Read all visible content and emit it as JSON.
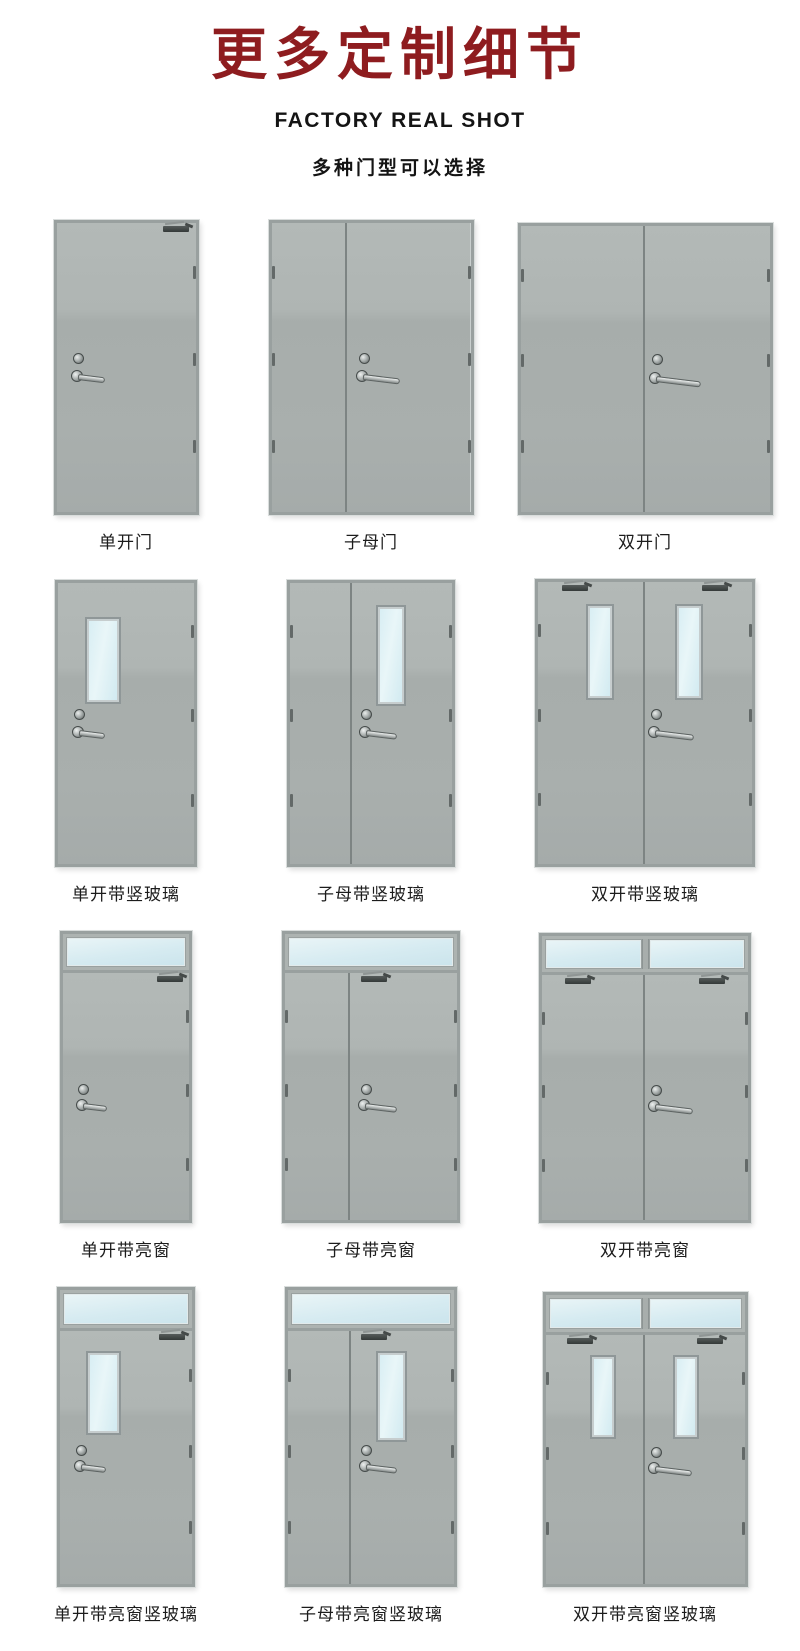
{
  "header": {
    "title": "更多定制细节",
    "subtitle_en": "FACTORY REAL SHOT",
    "subtitle_cn": "多种门型可以选择"
  },
  "colors": {
    "title_red": "#8e1c1f",
    "door_gray": "#a9afad",
    "frame_gray": "#99a09f",
    "glass_blue": "#d6ebf1",
    "label_black": "#1c1c1c"
  },
  "doors": [
    {
      "label": "单开门",
      "type": "single",
      "transom": false,
      "vertical_glass": false,
      "closers": "right"
    },
    {
      "label": "子母门",
      "type": "mother-child",
      "transom": false,
      "vertical_glass": false,
      "closers": "none"
    },
    {
      "label": "双开门",
      "type": "double",
      "transom": false,
      "vertical_glass": false,
      "closers": "none"
    },
    {
      "label": "单开带竖玻璃",
      "type": "single",
      "transom": false,
      "vertical_glass": true,
      "closers": "none"
    },
    {
      "label": "子母带竖玻璃",
      "type": "mother-child",
      "transom": false,
      "vertical_glass": true,
      "closers": "none"
    },
    {
      "label": "双开带竖玻璃",
      "type": "double",
      "transom": false,
      "vertical_glass": true,
      "closers": "both"
    },
    {
      "label": "单开带亮窗",
      "type": "single",
      "transom": true,
      "vertical_glass": false,
      "closers": "right"
    },
    {
      "label": "子母带亮窗",
      "type": "mother-child",
      "transom": true,
      "vertical_glass": false,
      "closers": "main"
    },
    {
      "label": "双开带亮窗",
      "type": "double",
      "transom": true,
      "vertical_glass": false,
      "closers": "both"
    },
    {
      "label": "单开带亮窗竖玻璃",
      "type": "single",
      "transom": true,
      "vertical_glass": true,
      "closers": "right"
    },
    {
      "label": "子母带亮窗竖玻璃",
      "type": "mother-child",
      "transom": true,
      "vertical_glass": true,
      "closers": "main"
    },
    {
      "label": "双开带亮窗竖玻璃",
      "type": "double",
      "transom": true,
      "vertical_glass": true,
      "closers": "both"
    }
  ]
}
